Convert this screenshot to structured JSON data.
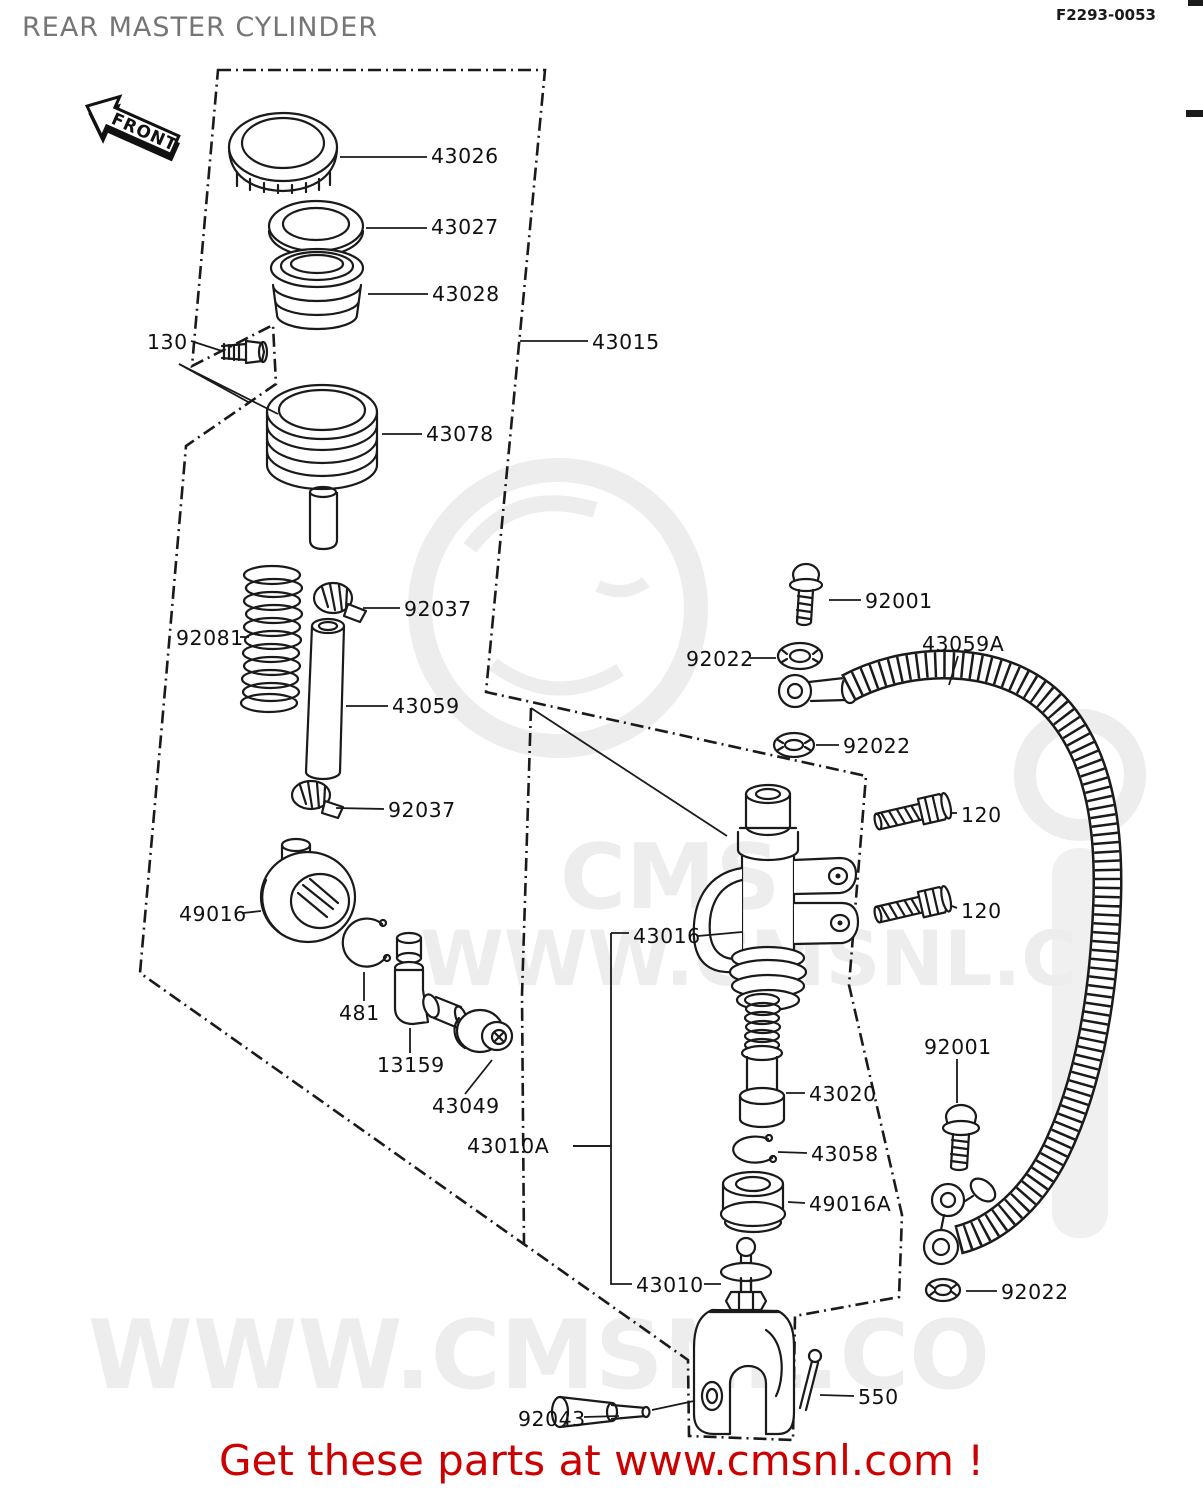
{
  "title": "REAR MASTER CYLINDER",
  "doc_number": "F2293-0053",
  "front_marker": "FRONT",
  "banner": {
    "text": "Get these parts at www.cmsnl.com !",
    "color": "#cc0000"
  },
  "watermark": {
    "brand": "CMS",
    "url_mid": "WWW.CMSNL.C",
    "url_bottom": "WWW.CMSNL.CO",
    "color": "#ededed"
  },
  "colors": {
    "background": "#ffffff",
    "line": "#1a1a1a",
    "title_gray": "#757575",
    "banner_red": "#cc0000"
  },
  "parts_labels": [
    {
      "id": "130",
      "text": "130",
      "x": 147,
      "y": 349,
      "leaders": [
        [
          191,
          341,
          222,
          351
        ],
        [
          179,
          364,
          250,
          403
        ],
        [
          179,
          364,
          278,
          414
        ]
      ]
    },
    {
      "id": "43026",
      "text": "43026",
      "x": 431,
      "y": 163,
      "leaders": [
        [
          340,
          157,
          427,
          157
        ]
      ]
    },
    {
      "id": "43027",
      "text": "43027",
      "x": 431,
      "y": 234,
      "leaders": [
        [
          366,
          228,
          427,
          228
        ]
      ]
    },
    {
      "id": "43028",
      "text": "43028",
      "x": 432,
      "y": 301,
      "leaders": [
        [
          368,
          294,
          428,
          294
        ]
      ]
    },
    {
      "id": "43015",
      "text": "43015",
      "x": 592,
      "y": 349,
      "leaders": [
        [
          520,
          341,
          588,
          341
        ]
      ]
    },
    {
      "id": "43078",
      "text": "43078",
      "x": 426,
      "y": 441,
      "leaders": [
        [
          382,
          434,
          422,
          434
        ]
      ]
    },
    {
      "id": "92037-upper",
      "text": "92037",
      "x": 404,
      "y": 616,
      "leaders": [
        [
          363,
          608,
          400,
          608
        ]
      ]
    },
    {
      "id": "92081",
      "text": "92081",
      "x": 176,
      "y": 645,
      "leaders": [
        [
          240,
          637,
          249,
          637
        ]
      ]
    },
    {
      "id": "43059",
      "text": "43059",
      "x": 392,
      "y": 713,
      "leaders": [
        [
          346,
          706,
          388,
          706
        ]
      ]
    },
    {
      "id": "92037-lower",
      "text": "92037",
      "x": 388,
      "y": 817,
      "leaders": [
        [
          336,
          808,
          384,
          809
        ]
      ]
    },
    {
      "id": "49016",
      "text": "49016",
      "x": 179,
      "y": 921,
      "leaders": [
        [
          243,
          913,
          261,
          911
        ]
      ]
    },
    {
      "id": "481",
      "text": "481",
      "x": 339,
      "y": 1020,
      "leaders": [
        [
          364,
          1001,
          364,
          972
        ]
      ]
    },
    {
      "id": "13159",
      "text": "13159",
      "x": 377,
      "y": 1072,
      "leaders": [
        [
          410,
          1053,
          410,
          1028
        ]
      ]
    },
    {
      "id": "43049",
      "text": "43049",
      "x": 432,
      "y": 1113,
      "leaders": [
        [
          465,
          1094,
          492,
          1060
        ]
      ]
    },
    {
      "id": "43010A",
      "text": "43010A",
      "x": 467,
      "y": 1153,
      "leaders": [
        [
          573,
          1146,
          611,
          1146
        ]
      ]
    },
    {
      "id": "43016",
      "text": "43016",
      "x": 633,
      "y": 943,
      "leaders": [
        [
          698,
          936,
          742,
          932
        ]
      ]
    },
    {
      "id": "92001-top",
      "text": "92001",
      "x": 865,
      "y": 608,
      "leaders": [
        [
          829,
          600,
          861,
          600
        ]
      ]
    },
    {
      "id": "92022-a",
      "text": "92022",
      "x": 686,
      "y": 666,
      "leaders": [
        [
          750,
          658,
          776,
          658
        ]
      ]
    },
    {
      "id": "43059A",
      "text": "43059A",
      "x": 922,
      "y": 651,
      "leaders": [
        [
          958,
          656,
          949,
          685
        ]
      ]
    },
    {
      "id": "92022-b",
      "text": "92022",
      "x": 843,
      "y": 753,
      "leaders": [
        [
          839,
          745,
          816,
          745
        ]
      ]
    },
    {
      "id": "120-upper",
      "text": "120",
      "x": 961,
      "y": 822,
      "leaders": [
        [
          957,
          813,
          950,
          813
        ]
      ]
    },
    {
      "id": "120-lower",
      "text": "120",
      "x": 961,
      "y": 918,
      "leaders": [
        [
          957,
          908,
          952,
          906
        ]
      ]
    },
    {
      "id": "92001-right",
      "text": "92001",
      "x": 924,
      "y": 1054,
      "leaders": [
        [
          957,
          1059,
          957,
          1103
        ]
      ]
    },
    {
      "id": "43020",
      "text": "43020",
      "x": 809,
      "y": 1101,
      "leaders": [
        [
          786,
          1093,
          805,
          1093
        ]
      ]
    },
    {
      "id": "43058",
      "text": "43058",
      "x": 811,
      "y": 1161,
      "leaders": [
        [
          778,
          1152,
          807,
          1153
        ]
      ]
    },
    {
      "id": "49016A",
      "text": "49016A",
      "x": 809,
      "y": 1211,
      "leaders": [
        [
          788,
          1202,
          805,
          1203
        ]
      ]
    },
    {
      "id": "43010",
      "text": "43010",
      "x": 636,
      "y": 1292,
      "leaders": [
        [
          704,
          1284,
          721,
          1284
        ]
      ]
    },
    {
      "id": "92043",
      "text": "92043",
      "x": 518,
      "y": 1426,
      "leaders": [
        [
          584,
          1417,
          619,
          1416
        ]
      ]
    },
    {
      "id": "550",
      "text": "550",
      "x": 858,
      "y": 1404,
      "leaders": [
        [
          854,
          1396,
          820,
          1395
        ]
      ]
    },
    {
      "id": "92022-c",
      "text": "92022",
      "x": 1001,
      "y": 1299,
      "leaders": [
        [
          997,
          1291,
          966,
          1291
        ]
      ]
    }
  ]
}
